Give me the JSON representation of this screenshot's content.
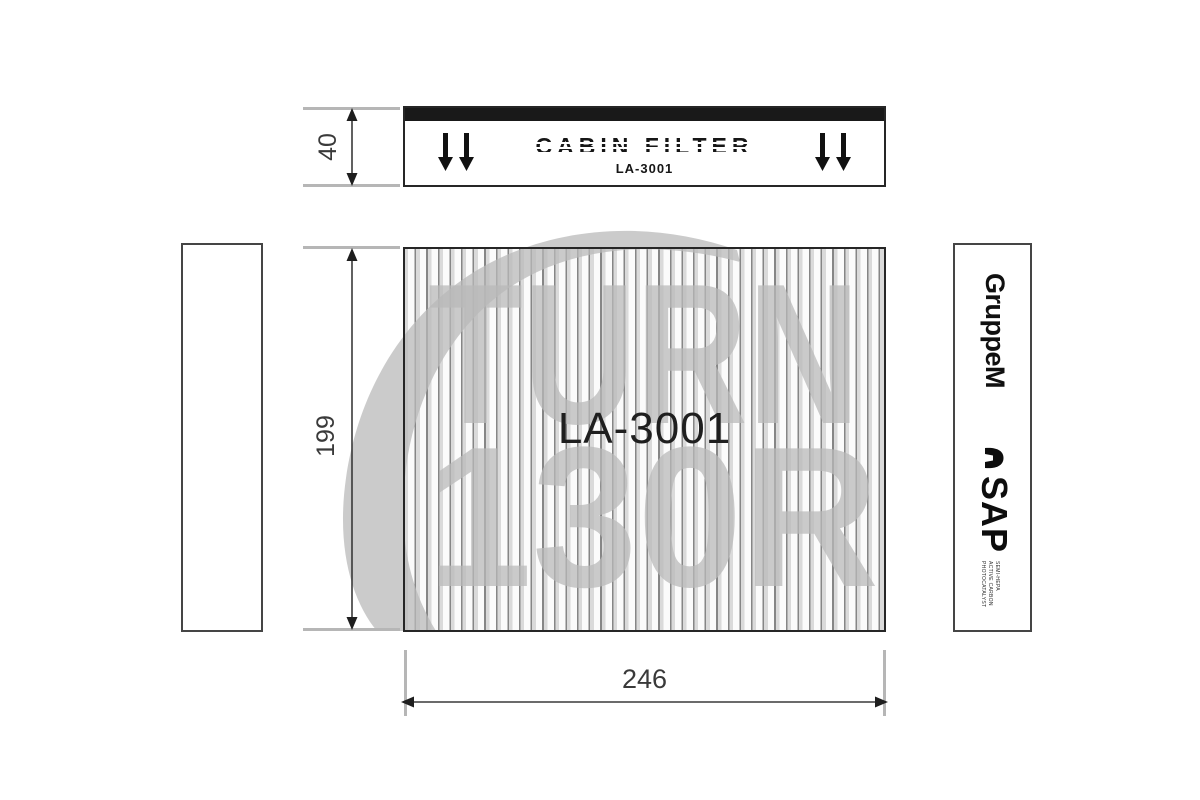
{
  "diagram": {
    "top_view": {
      "title": "CABIN FILTER",
      "part_number": "LA-3001"
    },
    "front_view": {
      "part_number": "LA-3001"
    },
    "dimensions": {
      "top_height_mm": "40",
      "front_height_mm": "199",
      "front_width_mm": "246"
    },
    "right_panel": {
      "brand": "GruppeM",
      "product_line": "SAP",
      "spec_lines": [
        "SEMI-HEPA",
        "ACTIVE CARBON",
        "PHOTOCATALYST"
      ]
    },
    "watermark": {
      "line1": "TURN",
      "line2": "130R"
    }
  },
  "colors": {
    "line_art": "#262626",
    "extension_line": "#b6b6b6",
    "watermark_gray": "#b9b9b9",
    "top_band": "#191919",
    "dimension_text": "#3a3a3a",
    "pleat_line": "#868686"
  }
}
